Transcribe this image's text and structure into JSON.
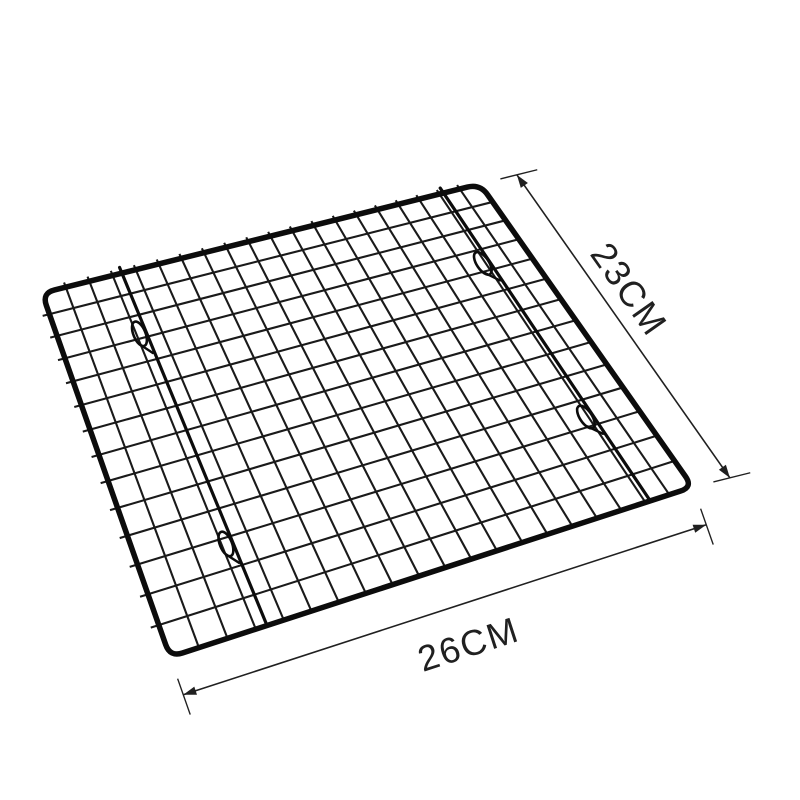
{
  "canvas": {
    "background_color": "#ffffff"
  },
  "rack": {
    "wire_color": "#1a1a1a",
    "frame_color": "#0c0c0c",
    "grid_columns": 20,
    "grid_rows": 14
  },
  "dimensions": {
    "annotation_color": "#202020",
    "side": {
      "label": "23CM"
    },
    "front": {
      "label": "26CM"
    }
  }
}
